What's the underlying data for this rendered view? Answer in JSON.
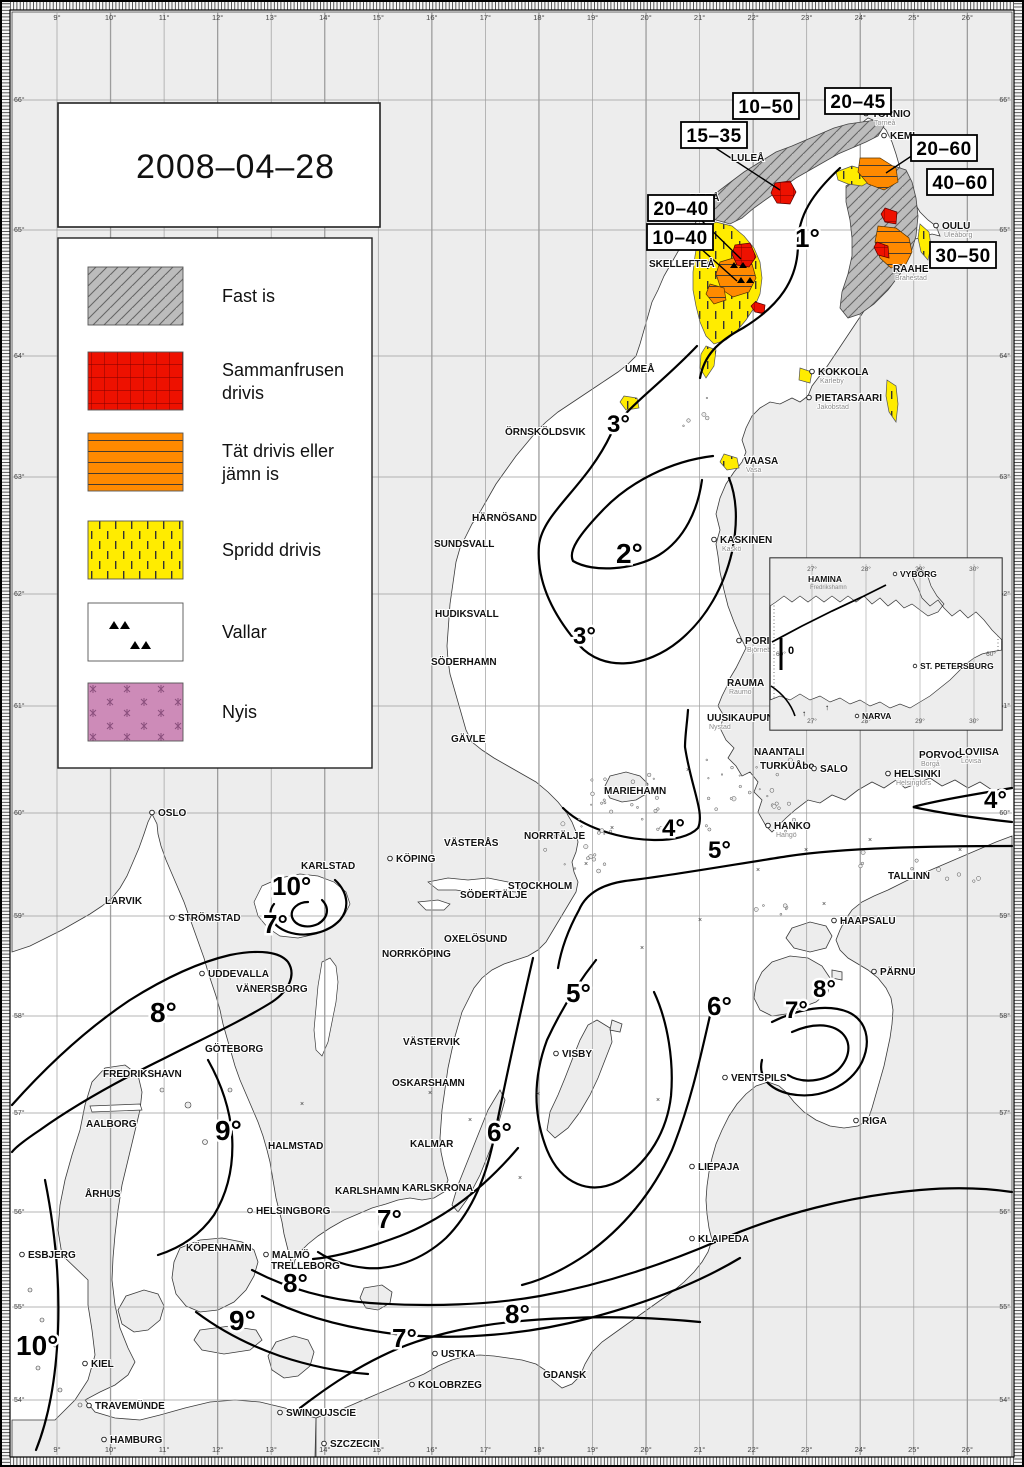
{
  "title": {
    "date": "2008–04–28"
  },
  "legend": {
    "items": [
      {
        "id": "fast-ice",
        "label": "Fast is",
        "lines": [
          "Fast is"
        ],
        "color": "#bcbcbc"
      },
      {
        "id": "consolidated-drift",
        "label": "Sammanfrusen drivis",
        "lines": [
          "Sammanfrusen",
          "drivis"
        ],
        "color": "#ee1100"
      },
      {
        "id": "close-drift-ice",
        "label": "Tät drivis eller jämn is",
        "lines": [
          "Tät drivis eller",
          "jämn is"
        ],
        "color": "#ff8a00"
      },
      {
        "id": "open-drift-ice",
        "label": "Spridd drivis",
        "lines": [
          "Spridd drivis"
        ],
        "color": "#ffec00"
      },
      {
        "id": "ridges",
        "label": "Vallar",
        "lines": [
          "Vallar"
        ],
        "color": "#ffffff"
      },
      {
        "id": "new-ice",
        "label": "Nyis",
        "lines": [
          "Nyis"
        ],
        "color": "#cd8bb8"
      }
    ]
  },
  "ice_thickness_labels": [
    {
      "text": "10–50",
      "x": 766,
      "y": 106
    },
    {
      "text": "20–45",
      "x": 858,
      "y": 101
    },
    {
      "text": "15–35",
      "x": 714,
      "y": 135
    },
    {
      "text": "20–60",
      "x": 944,
      "y": 148
    },
    {
      "text": "40–60",
      "x": 960,
      "y": 182
    },
    {
      "text": "20–40",
      "x": 681,
      "y": 208
    },
    {
      "text": "10–40",
      "x": 680,
      "y": 237
    },
    {
      "text": "30–50",
      "x": 963,
      "y": 255
    }
  ],
  "isotherm_labels": [
    {
      "text": "1°",
      "x": 795,
      "y": 247,
      "size": 26
    },
    {
      "text": "3°",
      "x": 607,
      "y": 432,
      "size": 24
    },
    {
      "text": "2°",
      "x": 616,
      "y": 563,
      "size": 28
    },
    {
      "text": "3°",
      "x": 573,
      "y": 644,
      "size": 24
    },
    {
      "text": "4°",
      "x": 662,
      "y": 836,
      "size": 24
    },
    {
      "text": "5°",
      "x": 708,
      "y": 858,
      "size": 24
    },
    {
      "text": "4°",
      "x": 984,
      "y": 808,
      "size": 24
    },
    {
      "text": "10°",
      "x": 272,
      "y": 895,
      "size": 26
    },
    {
      "text": "7°",
      "x": 263,
      "y": 933,
      "size": 26
    },
    {
      "text": "8°",
      "x": 150,
      "y": 1022,
      "size": 28
    },
    {
      "text": "9°",
      "x": 215,
      "y": 1140,
      "size": 28
    },
    {
      "text": "5°",
      "x": 566,
      "y": 1002,
      "size": 26
    },
    {
      "text": "6°",
      "x": 707,
      "y": 1015,
      "size": 26
    },
    {
      "text": "8°",
      "x": 813,
      "y": 997,
      "size": 24
    },
    {
      "text": "7°",
      "x": 785,
      "y": 1018,
      "size": 24
    },
    {
      "text": "6°",
      "x": 487,
      "y": 1141,
      "size": 26
    },
    {
      "text": "7°",
      "x": 377,
      "y": 1228,
      "size": 26
    },
    {
      "text": "8°",
      "x": 283,
      "y": 1292,
      "size": 26
    },
    {
      "text": "9°",
      "x": 229,
      "y": 1330,
      "size": 28
    },
    {
      "text": "7°",
      "x": 392,
      "y": 1347,
      "size": 26
    },
    {
      "text": "8°",
      "x": 505,
      "y": 1323,
      "size": 26
    },
    {
      "text": "10°",
      "x": 16,
      "y": 1355,
      "size": 28
    }
  ],
  "cities": [
    {
      "n": "TORNIO",
      "s": "Torneå",
      "x": 872,
      "y": 117,
      "d": true
    },
    {
      "n": "KEMI",
      "s": "",
      "x": 890,
      "y": 139,
      "d": true
    },
    {
      "n": "LULEÅ",
      "s": "",
      "x": 731,
      "y": 161,
      "d": false
    },
    {
      "n": "PITEÅ",
      "s": "",
      "x": 690,
      "y": 201,
      "d": false
    },
    {
      "n": "SKELLEFTEÅ",
      "s": "",
      "x": 649,
      "y": 267,
      "d": false
    },
    {
      "n": "UMEÅ",
      "s": "",
      "x": 625,
      "y": 372,
      "d": false
    },
    {
      "n": "ÖRNSKÖLDSVIK",
      "s": "",
      "x": 505,
      "y": 435,
      "d": false
    },
    {
      "n": "HÄRNÖSAND",
      "s": "",
      "x": 472,
      "y": 521,
      "d": false
    },
    {
      "n": "SUNDSVALL",
      "s": "",
      "x": 434,
      "y": 547,
      "d": false
    },
    {
      "n": "HUDIKSVALL",
      "s": "",
      "x": 435,
      "y": 617,
      "d": false
    },
    {
      "n": "SÖDERHAMN",
      "s": "",
      "x": 431,
      "y": 665,
      "d": false
    },
    {
      "n": "GÄVLE",
      "s": "",
      "x": 451,
      "y": 742,
      "d": false
    },
    {
      "n": "OULU",
      "s": "Uleåborg",
      "x": 942,
      "y": 229,
      "d": true
    },
    {
      "n": "RAAHE",
      "s": "Brahestad",
      "x": 893,
      "y": 272,
      "d": false
    },
    {
      "n": "KOKKOLA",
      "s": "Karleby",
      "x": 818,
      "y": 375,
      "d": true
    },
    {
      "n": "PIETARSAARI",
      "s": "Jakobstad",
      "x": 815,
      "y": 401,
      "d": true
    },
    {
      "n": "VAASA",
      "s": "Vasa",
      "x": 744,
      "y": 464,
      "d": false
    },
    {
      "n": "KASKINEN",
      "s": "Kaskö",
      "x": 720,
      "y": 543,
      "d": true
    },
    {
      "n": "PORI",
      "s": "Björneborg",
      "x": 745,
      "y": 644,
      "d": true
    },
    {
      "n": "RAUMA",
      "s": "Raumo",
      "x": 727,
      "y": 686,
      "d": false
    },
    {
      "n": "UUSIKAUPUNK",
      "s": "Nystad",
      "x": 707,
      "y": 721,
      "d": false
    },
    {
      "n": "NAANTALI",
      "s": "",
      "x": 754,
      "y": 755,
      "d": false
    },
    {
      "n": "TURKUÅbo",
      "s": "",
      "x": 760,
      "y": 769,
      "d": false
    },
    {
      "n": "SALO",
      "s": "",
      "x": 820,
      "y": 772,
      "d": true
    },
    {
      "n": "HELSINKI",
      "s": "Helsingfors",
      "x": 894,
      "y": 777,
      "d": true
    },
    {
      "n": "PORVOO",
      "s": "Borgå",
      "x": 919,
      "y": 758,
      "d": false
    },
    {
      "n": "LOVIISA",
      "s": "Lovisa",
      "x": 959,
      "y": 755,
      "d": false
    },
    {
      "n": "HANKO",
      "s": "Hangö",
      "x": 774,
      "y": 829,
      "d": true
    },
    {
      "n": "MARIEHAMN",
      "s": "",
      "x": 604,
      "y": 794,
      "d": false
    },
    {
      "n": "STOCKHOLM",
      "s": "",
      "x": 508,
      "y": 889,
      "d": false
    },
    {
      "n": "NORRTÄLJE",
      "s": "",
      "x": 524,
      "y": 839,
      "d": false
    },
    {
      "n": "VÄSTERÅS",
      "s": "",
      "x": 444,
      "y": 846,
      "d": false
    },
    {
      "n": "KÖPING",
      "s": "",
      "x": 396,
      "y": 862,
      "d": true
    },
    {
      "n": "SÖDERTÄLJE",
      "s": "",
      "x": 460,
      "y": 898,
      "d": false
    },
    {
      "n": "OXELÖSUND",
      "s": "",
      "x": 444,
      "y": 942,
      "d": false
    },
    {
      "n": "NORRKÖPING",
      "s": "",
      "x": 382,
      "y": 957,
      "d": false
    },
    {
      "n": "VÄSTERVIK",
      "s": "",
      "x": 403,
      "y": 1045,
      "d": false
    },
    {
      "n": "OSKARSHAMN",
      "s": "",
      "x": 392,
      "y": 1086,
      "d": false
    },
    {
      "n": "KALMAR",
      "s": "",
      "x": 410,
      "y": 1147,
      "d": false
    },
    {
      "n": "KARLSKRONA",
      "s": "",
      "x": 402,
      "y": 1191,
      "d": false
    },
    {
      "n": "KARLSHAMN",
      "s": "",
      "x": 335,
      "y": 1194,
      "d": false
    },
    {
      "n": "VISBY",
      "s": "",
      "x": 562,
      "y": 1057,
      "d": true
    },
    {
      "n": "OSLO",
      "s": "",
      "x": 158,
      "y": 816,
      "d": true
    },
    {
      "n": "LARVIK",
      "s": "",
      "x": 105,
      "y": 904,
      "d": false
    },
    {
      "n": "STRÖMSTAD",
      "s": "",
      "x": 178,
      "y": 921,
      "d": true
    },
    {
      "n": "KARLSTAD",
      "s": "",
      "x": 301,
      "y": 869,
      "d": false
    },
    {
      "n": "UDDEVALLA",
      "s": "",
      "x": 208,
      "y": 977,
      "d": true
    },
    {
      "n": "VÄNERSBORG",
      "s": "",
      "x": 236,
      "y": 992,
      "d": false
    },
    {
      "n": "GÖTEBORG",
      "s": "",
      "x": 205,
      "y": 1052,
      "d": false
    },
    {
      "n": "FREDRIKSHAVN",
      "s": "",
      "x": 103,
      "y": 1077,
      "d": false
    },
    {
      "n": "AALBORG",
      "s": "",
      "x": 86,
      "y": 1127,
      "d": false
    },
    {
      "n": "ÅRHUS",
      "s": "",
      "x": 85,
      "y": 1197,
      "d": false
    },
    {
      "n": "ESBJERG",
      "s": "",
      "x": 28,
      "y": 1258,
      "d": true
    },
    {
      "n": "HALMSTAD",
      "s": "",
      "x": 268,
      "y": 1149,
      "d": false
    },
    {
      "n": "HELSINGBORG",
      "s": "",
      "x": 256,
      "y": 1214,
      "d": true
    },
    {
      "n": "KÖPENHAMN",
      "s": "",
      "x": 186,
      "y": 1251,
      "d": false
    },
    {
      "n": "MALMÖ",
      "s": "",
      "x": 272,
      "y": 1258,
      "d": true
    },
    {
      "n": "TRELLEBORG",
      "s": "",
      "x": 271,
      "y": 1269,
      "d": false
    },
    {
      "n": "KIEL",
      "s": "",
      "x": 91,
      "y": 1367,
      "d": true
    },
    {
      "n": "TRAVEMÜNDE",
      "s": "",
      "x": 95,
      "y": 1409,
      "d": true
    },
    {
      "n": "HAMBURG",
      "s": "",
      "x": 110,
      "y": 1443,
      "d": true
    },
    {
      "n": "SWINOUJSCIE",
      "s": "",
      "x": 286,
      "y": 1416,
      "d": true
    },
    {
      "n": "SZCZECIN",
      "s": "",
      "x": 330,
      "y": 1447,
      "d": true
    },
    {
      "n": "USTKA",
      "s": "",
      "x": 441,
      "y": 1357,
      "d": true
    },
    {
      "n": "KOLOBRZEG",
      "s": "",
      "x": 418,
      "y": 1388,
      "d": true
    },
    {
      "n": "GDANSK",
      "s": "",
      "x": 543,
      "y": 1378,
      "d": false
    },
    {
      "n": "KLAIPEDA",
      "s": "",
      "x": 698,
      "y": 1242,
      "d": true
    },
    {
      "n": "LIEPAJA",
      "s": "",
      "x": 698,
      "y": 1170,
      "d": true
    },
    {
      "n": "VENTSPILS",
      "s": "",
      "x": 731,
      "y": 1081,
      "d": true
    },
    {
      "n": "RIGA",
      "s": "",
      "x": 862,
      "y": 1124,
      "d": true
    },
    {
      "n": "PÄRNU",
      "s": "",
      "x": 880,
      "y": 975,
      "d": true
    },
    {
      "n": "HAAPSALU",
      "s": "",
      "x": 840,
      "y": 924,
      "d": true
    },
    {
      "n": "TALLINN",
      "s": "",
      "x": 888,
      "y": 879,
      "d": false
    }
  ],
  "inset": {
    "cities": [
      {
        "n": "HAMINA",
        "s": "Fredrikshamn",
        "x": 808,
        "y": 582,
        "d": false
      },
      {
        "n": "VYBORG",
        "s": "",
        "x": 900,
        "y": 577,
        "d": true
      },
      {
        "n": "ST. PETERSBURG",
        "s": "",
        "x": 920,
        "y": 669,
        "d": true
      },
      {
        "n": "NARVA",
        "s": "",
        "x": 862,
        "y": 719,
        "d": true
      }
    ],
    "zero_label": "0",
    "lon_labels": [
      "27°",
      "28°",
      "29°",
      "30°"
    ],
    "lat_label": "60°"
  },
  "grid": {
    "lon_labels": [
      "9°",
      "10°",
      "11°",
      "12°",
      "13°",
      "14°",
      "15°",
      "16°",
      "17°",
      "18°",
      "19°",
      "20°",
      "21°",
      "22°",
      "23°",
      "24°",
      "25°",
      "26°"
    ],
    "lat_labels": [
      "66°",
      "65°",
      "64°",
      "63°",
      "62°",
      "61°",
      "60°",
      "59°",
      "58°",
      "57°",
      "56°",
      "55°",
      "54°"
    ]
  },
  "colors": {
    "land": "#ededed",
    "sea": "#ffffff",
    "grid_line": "#9d9d9d",
    "coast": "#3a3a3a",
    "contour": "#000000",
    "fast_ice": "#bcbcbc",
    "consolidated_ice": "#ee1100",
    "close_drift_ice": "#ff8a00",
    "open_drift_ice": "#ffec00",
    "new_ice": "#cd8bb8"
  }
}
